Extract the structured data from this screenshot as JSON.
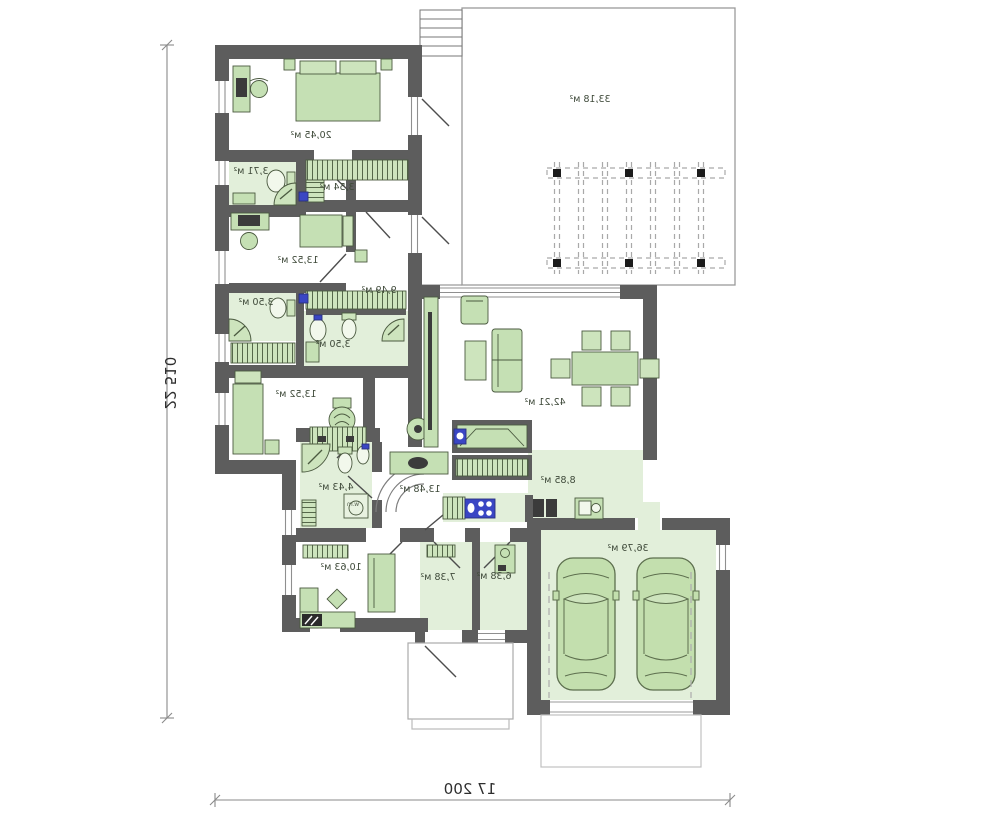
{
  "plan": {
    "type": "house-floor-plan-mirrored",
    "dimensions": {
      "bottom_width": "17 200",
      "left_height": "22 510"
    },
    "area_unit": "м²",
    "rooms": [
      {
        "id": "bedroom-main",
        "area": "20,45 м²",
        "x": 311,
        "y": 136
      },
      {
        "id": "bathroom-1",
        "area": "3,71 м²",
        "x": 251,
        "y": 172
      },
      {
        "id": "wardrobe",
        "area": "3,54 м²",
        "x": 337,
        "y": 188
      },
      {
        "id": "bedroom-2",
        "area": "13,52 м²",
        "x": 298,
        "y": 261
      },
      {
        "id": "corridor",
        "area": "9,49 м²",
        "x": 379,
        "y": 291
      },
      {
        "id": "bathroom-2",
        "area": "3,50 м²",
        "x": 256,
        "y": 303
      },
      {
        "id": "bathroom-3",
        "area": "3,50 м²",
        "x": 333,
        "y": 345
      },
      {
        "id": "bedroom-3",
        "area": "13,52 м²",
        "x": 296,
        "y": 395
      },
      {
        "id": "wc",
        "area": "4,43 м²",
        "x": 336,
        "y": 488
      },
      {
        "id": "hall",
        "area": "13,48 м²",
        "x": 420,
        "y": 490
      },
      {
        "id": "living-room",
        "area": "42,21 м²",
        "x": 545,
        "y": 403
      },
      {
        "id": "kitchen",
        "area": "8,85 м²",
        "x": 558,
        "y": 481
      },
      {
        "id": "garage",
        "area": "36,79 м²",
        "x": 628,
        "y": 549
      },
      {
        "id": "office",
        "area": "10,63 м²",
        "x": 341,
        "y": 568
      },
      {
        "id": "utility",
        "area": "7,38 м²",
        "x": 438,
        "y": 578
      },
      {
        "id": "boiler-room",
        "area": "6,38 м²",
        "x": 494,
        "y": 577
      },
      {
        "id": "terrace",
        "area": "33,18 м²",
        "x": 590,
        "y": 100
      }
    ],
    "appliance_labels": [
      {
        "id": "washing-machine",
        "text": "w.m",
        "x": 353,
        "y": 505
      }
    ],
    "colors": {
      "wall": "#5d5d5d",
      "furniture_fill": "#c5e0b4",
      "furniture_stroke": "#4b5a40",
      "floor_green": "#e2efda",
      "accent_blue": "#3a46c4",
      "line_gray": "#999999"
    }
  }
}
